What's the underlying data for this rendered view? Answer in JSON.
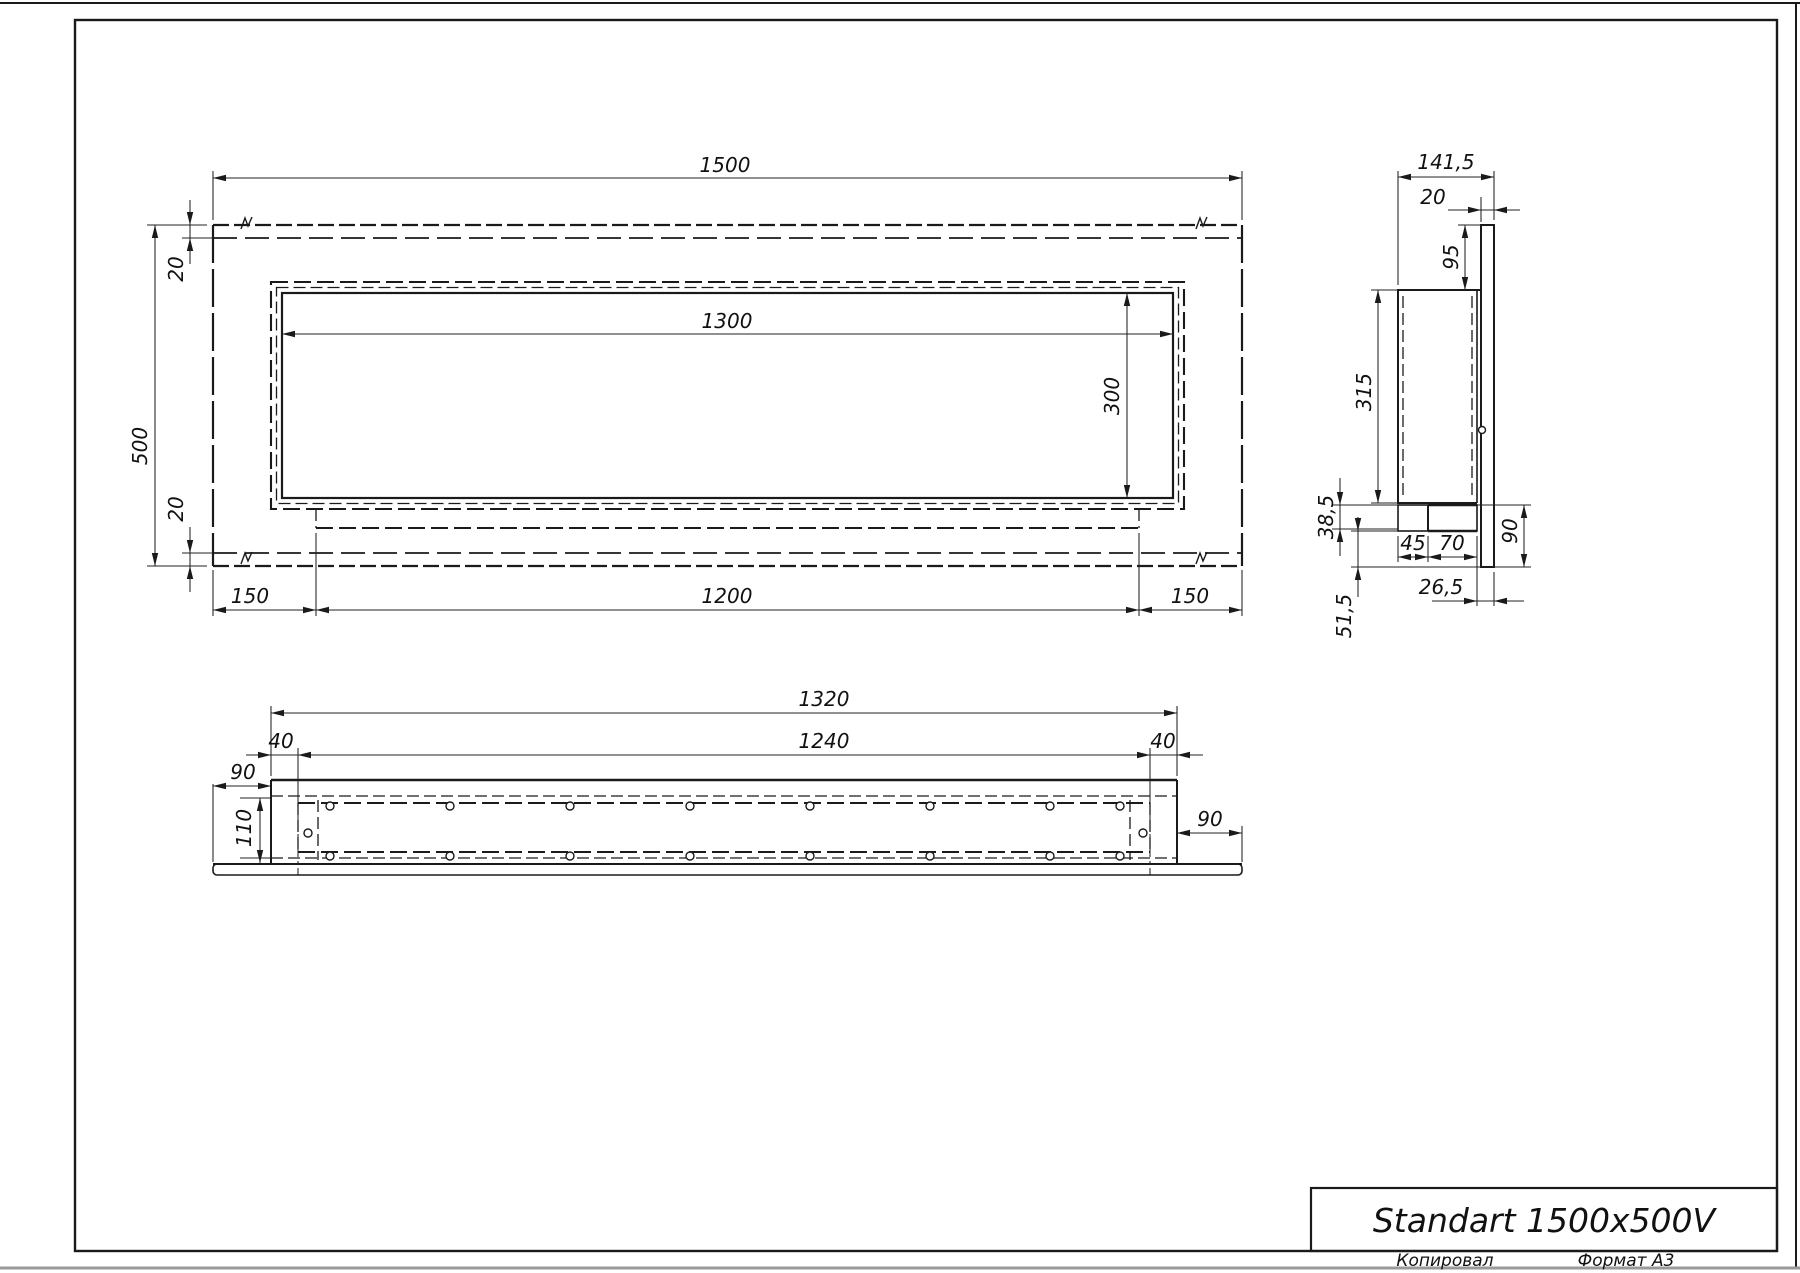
{
  "sheet": {
    "copied_label": "Копировал",
    "format_label": "Формат А3"
  },
  "title_block": {
    "product_name": "Standart 1500x500V"
  },
  "front_view": {
    "dims": {
      "overall_width": "1500",
      "overall_height": "500",
      "top_margin": "20",
      "bottom_margin": "20",
      "opening_width": "1300",
      "opening_height": "300",
      "left_offset": "150",
      "burner_length": "1200",
      "right_offset": "150"
    }
  },
  "side_view": {
    "dims": {
      "overall_depth": "141,5",
      "front_plate_thickness": "20",
      "top_reveal": "95",
      "body_height": "315",
      "tray_drop": "38,5",
      "tray_front": "45",
      "tray_back": "70",
      "front_lip_height": "90",
      "lip_offset": "26,5",
      "bottom_drop": "51,5"
    }
  },
  "bottom_view": {
    "dims": {
      "body_length": "1320",
      "opening_length": "1240",
      "left_inset": "40",
      "right_inset": "40",
      "left_flange": "90",
      "right_flange": "90",
      "depth": "110"
    }
  }
}
